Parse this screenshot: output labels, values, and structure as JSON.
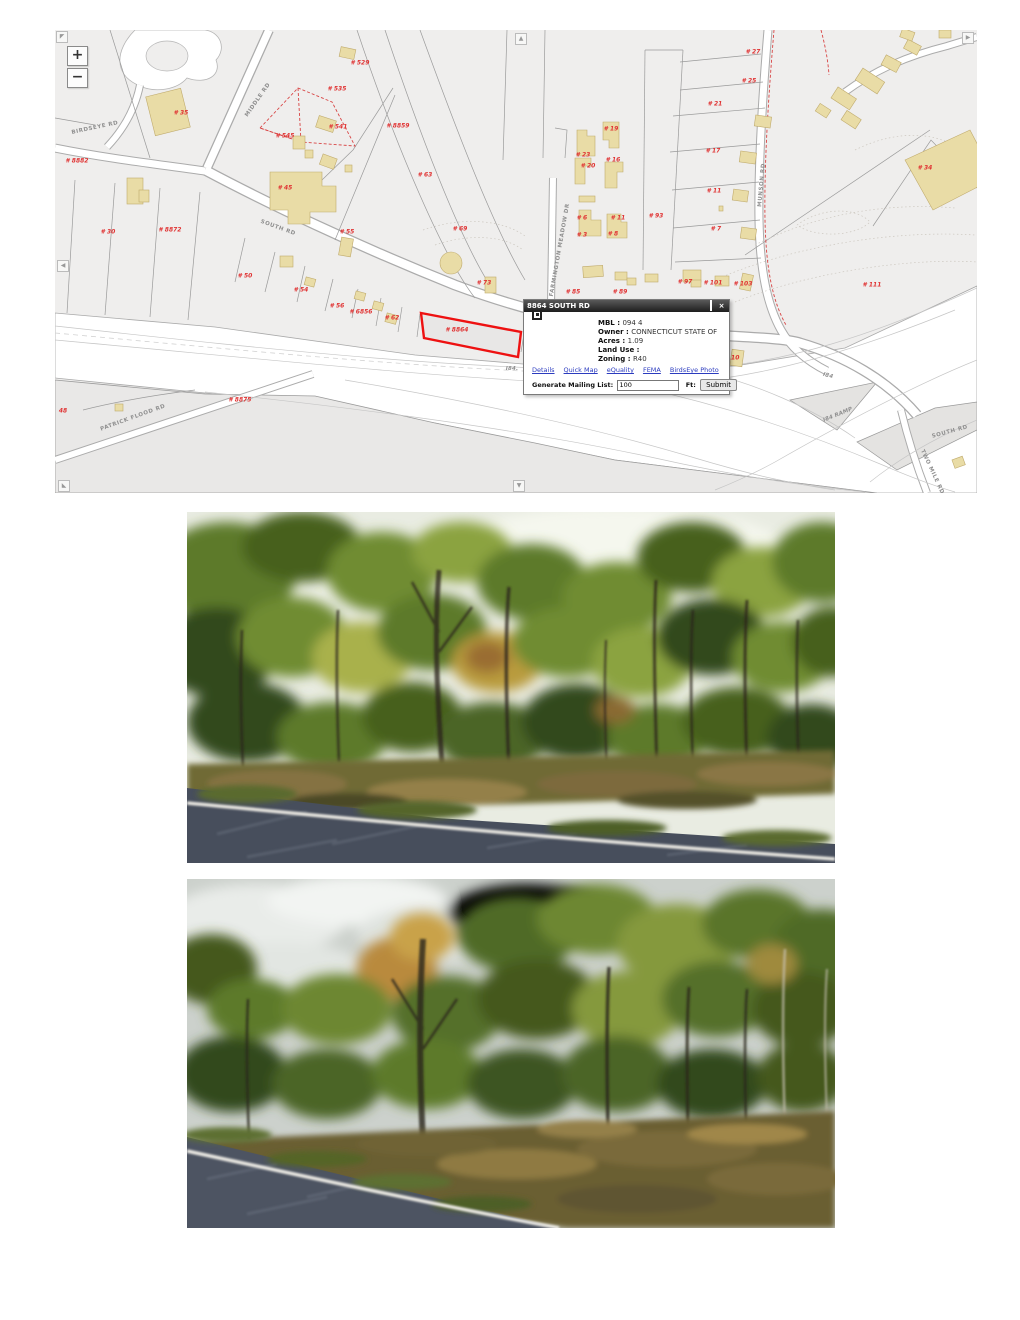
{
  "map": {
    "controls": {
      "zoom_in": "+",
      "zoom_out": "−"
    },
    "pan_icons": {
      "top_left": "◤",
      "up": "▲",
      "left": "◀",
      "bottom_left": "◣",
      "down": "▼",
      "right": "▶"
    },
    "colors": {
      "map_bg": "#efeeed",
      "building": "#e9dca6",
      "parcel_number": "#e03333",
      "highlight_outline": "#ee1111",
      "road_label": "#8f8f8f",
      "red_dash": "#d84444"
    },
    "popup": {
      "title": "8864 SOUTH RD",
      "close_icon": "×",
      "fields": [
        {
          "label": "MBL : ",
          "value": "094 4"
        },
        {
          "label": "Owner : ",
          "value": "CONNECTICUT STATE OF"
        },
        {
          "label": "Acres : ",
          "value": "1.09"
        },
        {
          "label": "Land Use : ",
          "value": ""
        },
        {
          "label": "Zoning : ",
          "value": "R40"
        }
      ],
      "links": [
        "Details",
        "Quick Map",
        "eQuality",
        "FEMA",
        "BirdsEye Photo"
      ],
      "mailing": {
        "label": "Generate Mailing List:",
        "value": "100",
        "unit": "Ft:",
        "submit": "Submit"
      }
    },
    "parcel_labels": [
      {
        "text": "# 35",
        "x": 126,
        "y": 83
      },
      {
        "text": "# 8882",
        "x": 22,
        "y": 131
      },
      {
        "text": "# 30",
        "x": 53,
        "y": 202
      },
      {
        "text": "# 8872",
        "x": 115,
        "y": 200
      },
      {
        "text": "# 529",
        "x": 305,
        "y": 33
      },
      {
        "text": "# 535",
        "x": 282,
        "y": 59
      },
      {
        "text": "# 541",
        "x": 283,
        "y": 97
      },
      {
        "text": "# 545",
        "x": 230,
        "y": 106
      },
      {
        "text": "# 45",
        "x": 230,
        "y": 158
      },
      {
        "text": "# 55",
        "x": 292,
        "y": 202
      },
      {
        "text": "# 8859",
        "x": 343,
        "y": 96
      },
      {
        "text": "# 63",
        "x": 370,
        "y": 145
      },
      {
        "text": "# 69",
        "x": 405,
        "y": 199
      },
      {
        "text": "# 73",
        "x": 429,
        "y": 253
      },
      {
        "text": "# 50",
        "x": 190,
        "y": 246
      },
      {
        "text": "# 54",
        "x": 246,
        "y": 260
      },
      {
        "text": "# 56",
        "x": 282,
        "y": 276
      },
      {
        "text": "# 6856",
        "x": 306,
        "y": 282
      },
      {
        "text": "# 62",
        "x": 337,
        "y": 288
      },
      {
        "text": "# 8875",
        "x": 185,
        "y": 370
      },
      {
        "text": "48",
        "x": 8,
        "y": 381
      },
      {
        "text": "# 8864",
        "x": 402,
        "y": 300
      },
      {
        "text": "# 85",
        "x": 518,
        "y": 262
      },
      {
        "text": "# 89",
        "x": 565,
        "y": 262
      },
      {
        "text": "# 97",
        "x": 630,
        "y": 252
      },
      {
        "text": "# 101",
        "x": 658,
        "y": 253
      },
      {
        "text": "# 103",
        "x": 688,
        "y": 254
      },
      {
        "text": "# 110",
        "x": 675,
        "y": 328
      },
      {
        "text": "# 111",
        "x": 817,
        "y": 255
      },
      {
        "text": "# 34",
        "x": 870,
        "y": 138
      },
      {
        "text": "# 19",
        "x": 556,
        "y": 99
      },
      {
        "text": "# 23",
        "x": 528,
        "y": 125
      },
      {
        "text": "# 20",
        "x": 533,
        "y": 136
      },
      {
        "text": "# 16",
        "x": 558,
        "y": 130
      },
      {
        "text": "# 6",
        "x": 527,
        "y": 188
      },
      {
        "text": "# 11",
        "x": 563,
        "y": 188
      },
      {
        "text": "# 3",
        "x": 527,
        "y": 205
      },
      {
        "text": "# 8",
        "x": 558,
        "y": 204
      },
      {
        "text": "# 93",
        "x": 601,
        "y": 186
      },
      {
        "text": "# 27",
        "x": 698,
        "y": 22
      },
      {
        "text": "# 25",
        "x": 694,
        "y": 51
      },
      {
        "text": "# 21",
        "x": 660,
        "y": 74
      },
      {
        "text": "# 17",
        "x": 658,
        "y": 121
      },
      {
        "text": "# 11",
        "x": 659,
        "y": 161
      },
      {
        "text": "# 7",
        "x": 661,
        "y": 199
      }
    ],
    "road_labels": [
      {
        "text": "BIRDSEYE RD",
        "x": 40,
        "y": 98,
        "angle": -12
      },
      {
        "text": "MIDDLE RD",
        "x": 203,
        "y": 70,
        "angle": -55
      },
      {
        "text": "SOUTH RD",
        "x": 223,
        "y": 198,
        "angle": 20
      },
      {
        "text": "FARMINGTON MEADOW DR",
        "x": 505,
        "y": 220,
        "angle": -80
      },
      {
        "text": "MUNSON RD",
        "x": 707,
        "y": 155,
        "angle": -85
      },
      {
        "text": "PATRICK FLOOD RD",
        "x": 78,
        "y": 388,
        "angle": -20
      },
      {
        "text": "I84.",
        "x": 457,
        "y": 339,
        "angle": 0,
        "italic": true
      },
      {
        "text": "I84",
        "x": 773,
        "y": 346,
        "angle": 15,
        "italic": true
      },
      {
        "text": "I84 RAMP",
        "x": 783,
        "y": 385,
        "angle": -22,
        "italic": true
      },
      {
        "text": "SOUTH RD",
        "x": 895,
        "y": 402,
        "angle": -15
      },
      {
        "text": "TWO MILE RD",
        "x": 877,
        "y": 442,
        "angle": 65
      }
    ]
  }
}
